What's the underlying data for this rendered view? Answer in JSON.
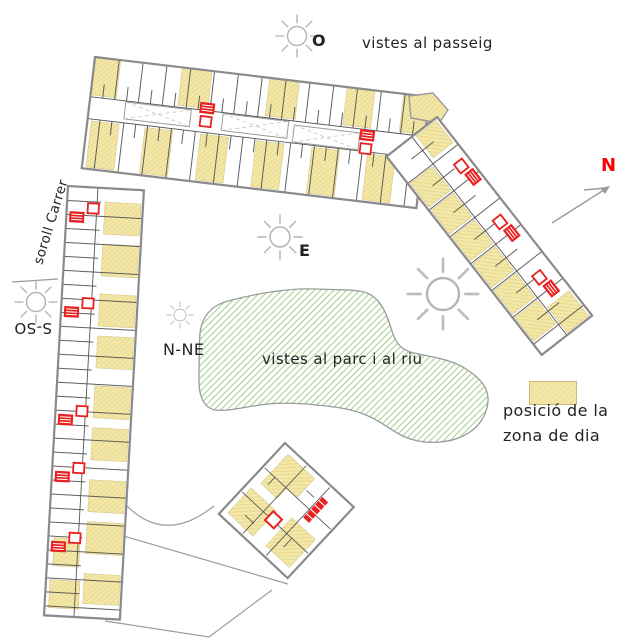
{
  "diagram": {
    "type": "architectural-site-plan",
    "labels": {
      "west_sun": "O",
      "views_promenade": "vistes al passeig",
      "east_sun": "E",
      "north_northeast_sun": "N-NE",
      "south_southwest_sun": "S-SO",
      "street_noise": "soroll Carrer",
      "views_park_river": "vistes al parc i al riu",
      "north": "N"
    },
    "legend": {
      "line1": "posició de la",
      "line2": "zona de dia"
    },
    "icons": {
      "sun_icon": "circle with radiating rays",
      "north_arrow_icon": "gray diagonal arrow pointing up-right",
      "day_zone_swatch": "yellow hatched rectangle",
      "stair_core_icon": "red hatched square with red outlined square",
      "park_area_icon": "green hatched organic blob"
    },
    "colors": {
      "day_zone_yellow": "#f3e8a8",
      "day_zone_border": "#cdbc82",
      "stair_red": "#e8201f",
      "park_green": "#aad295",
      "outline_gray": "#8a8a8a",
      "partition_gray": "#4d4d4d",
      "sun_gray": "#b5b5b5",
      "north_red": "#ff0000",
      "text_color": "#232323"
    }
  }
}
